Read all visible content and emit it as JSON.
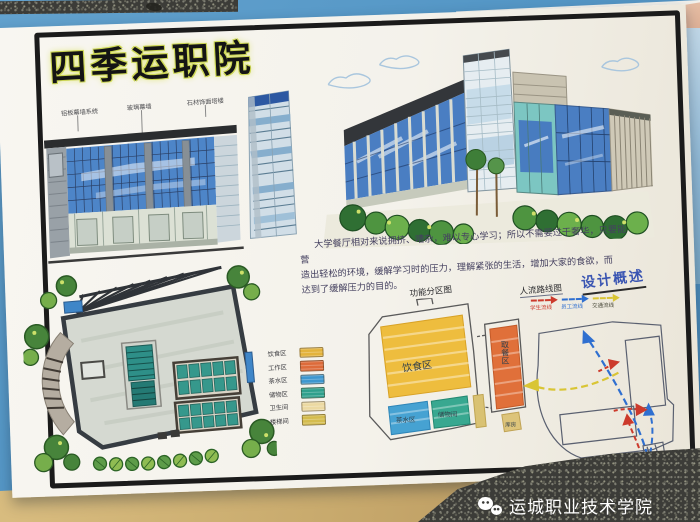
{
  "photo": {
    "watermark": {
      "icon": "wechat",
      "text": "运城职业技术学院"
    }
  },
  "board": {
    "title": "四季运职院",
    "elevation": {
      "labels": [
        "铝板幕墙系统",
        "玻璃幕墙",
        "石材饰面塔楼"
      ]
    },
    "overview": {
      "heading": "设计概述",
      "lines": [
        "大学餐厅相对来说拥挤、嘈杂，难以专心学习；所以不需要过于奢华，只要能营",
        "造出轻松的环境，缓解学习时的压力，理解紧张的生活，增加大家的食欲，而",
        "达到了缓解压力的目的。"
      ]
    },
    "legend": {
      "items": [
        {
          "label": "饮食区",
          "color": "#e3b33c"
        },
        {
          "label": "工作区",
          "color": "#dd6b3a"
        },
        {
          "label": "茶水区",
          "color": "#3e97cf"
        },
        {
          "label": "储物区",
          "color": "#2fa08c"
        },
        {
          "label": "卫生间",
          "color": "#ecd9a2"
        },
        {
          "label": "楼梯间",
          "color": "#d4bc4e"
        }
      ]
    },
    "zoning": {
      "title": "功能分区图",
      "zones": [
        {
          "label": "饮食区",
          "color": "#eebd3e"
        },
        {
          "label": "取餐区",
          "color": "#e0703a"
        },
        {
          "label": "茶水区",
          "color": "#46a2d2"
        },
        {
          "label": "储物间",
          "color": "#38a890"
        },
        {
          "label": "库房",
          "color": "#ddc47a"
        }
      ]
    },
    "circulation": {
      "title": "人流路线图",
      "flows": [
        {
          "label": "学生流线",
          "color": "#cc3a2c"
        },
        {
          "label": "员工流线",
          "color": "#2f6fd0"
        },
        {
          "label": "交通流线",
          "color": "#d9c535"
        }
      ]
    }
  }
}
